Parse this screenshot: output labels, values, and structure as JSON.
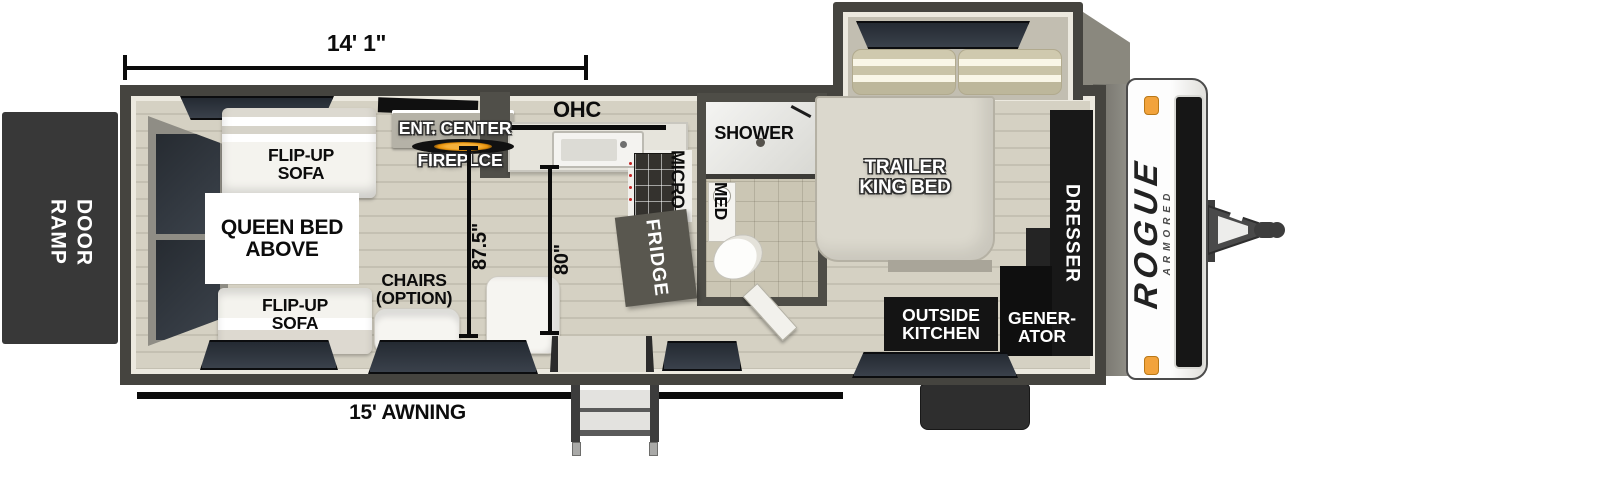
{
  "plan": {
    "dim_length": "14' 1\"",
    "dim_garage": "87.5\"",
    "dim_kitchen": "80\"",
    "awning": "15' AWNING",
    "ramp_door": "RAMP DOOR",
    "flip_sofa_top": "FLIP-UP SOFA",
    "flip_sofa_bottom": "FLIP-UP SOFA",
    "queen_bed": "QUEEN BED ABOVE",
    "ent_center": "ENT. CENTER",
    "fireplace": "FIREPLCE",
    "chairs": "CHAIRS (OPTION)",
    "ohc": "OHC",
    "micro": "MICRO",
    "fridge": "FRIDGE",
    "shower": "SHOWER",
    "med": "MED",
    "king_bed": "TRAILER KING BED",
    "dresser": "DRESSER",
    "outside_kitchen": "OUTSIDE KITCHEN",
    "generator": "GENER-ATOR",
    "logo_main": "ROGUE",
    "logo_sub": "ARMORED"
  },
  "colors": {
    "wall": "#45443f",
    "liner": "#ece9df",
    "floor": "#d5d1c3",
    "black_box": "#141414",
    "window_glass": "#2e353d",
    "marker_light": "#f2a33c",
    "white_furniture": "#f4f3ee",
    "fireplace_glow": "#e8920a"
  }
}
